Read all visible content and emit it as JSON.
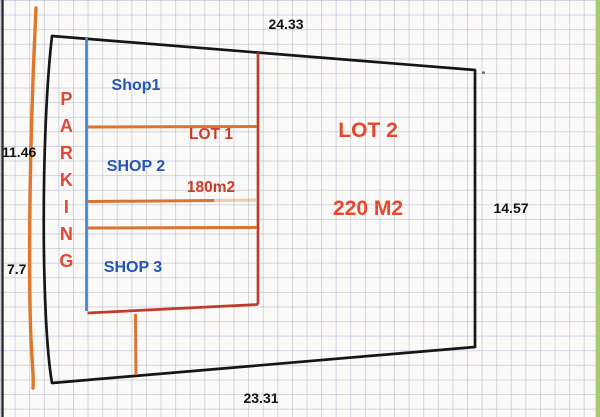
{
  "dimensions": {
    "top": "24.33",
    "left_upper": "11.46",
    "left_lower": "7.7",
    "right": "14.57",
    "bottom": "23.31"
  },
  "zones": {
    "parking": "PARKING",
    "shop1": "Shop1",
    "shop2": "SHOP 2",
    "shop3": "SHOP 3",
    "lot1": {
      "name": "LOT 1",
      "area": "180m2"
    },
    "lot2": {
      "name": "LOT 2",
      "area": "220 M2"
    }
  },
  "colors": {
    "outline_black": "#161616",
    "dimension_text": "#111111",
    "shop_text_blue": "#2257b8",
    "lot1_text_red": "#cc3a28",
    "lot2_text_red": "#e8472b",
    "parking_text_red": "#e14836",
    "boundary_blue_line": "#4285d4",
    "boundary_red_line": "#bf3b2b",
    "divider_orange_line": "#dd7330",
    "left_orange_line": "#e0762e",
    "edge_strip_green": "#a3cc70",
    "grid_line": "#c3cad6",
    "paper": "#fbfaf8"
  }
}
